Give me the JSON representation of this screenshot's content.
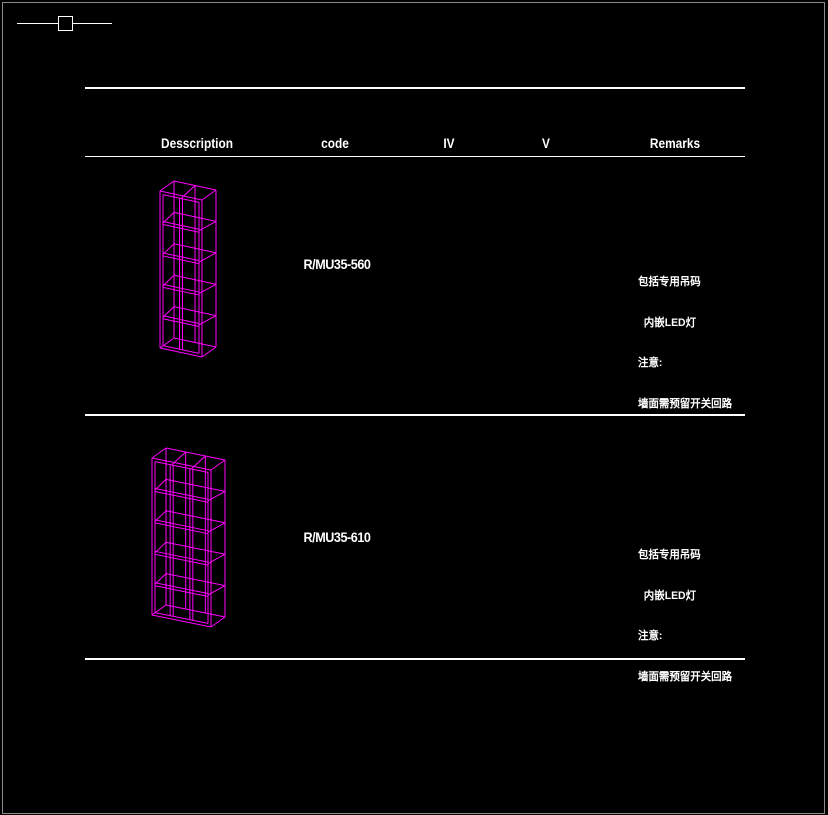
{
  "colors": {
    "background": "#000000",
    "frame_border": "#8a8a8a",
    "table_lines": "#ffffff",
    "text": "#ffffff",
    "wireframe": "#ff00ff"
  },
  "marker": {
    "name": "section-marker"
  },
  "table": {
    "headers": {
      "description": "Desscription",
      "code": "code",
      "iv": "IV",
      "v": "V",
      "remarks": "Remarks"
    },
    "rows": [
      {
        "code": "R/MU35-560",
        "iv": "",
        "v": "",
        "remarks": [
          "包括专用吊码",
          "  内嵌LED灯",
          "注意:",
          "墙面需预留开关回路"
        ],
        "drawing": {
          "type": "shelf-wireframe",
          "cols": 2,
          "rows": 5,
          "x": 160,
          "y": 191,
          "w": 42,
          "h": 157,
          "skew": 9,
          "dx": 14,
          "dy": -10,
          "t": 3,
          "color": "#ff00ff"
        }
      },
      {
        "code": "R/MU35-610",
        "iv": "",
        "v": "",
        "remarks": [
          "包括专用吊码",
          "  内嵌LED灯",
          "注意:",
          "墙面需预留开关回路"
        ],
        "drawing": {
          "type": "shelf-wireframe",
          "cols": 3,
          "rows": 5,
          "x": 152,
          "y": 458,
          "w": 59,
          "h": 157,
          "skew": 12,
          "dx": 14,
          "dy": -10,
          "t": 3,
          "color": "#ff00ff"
        }
      }
    ]
  }
}
